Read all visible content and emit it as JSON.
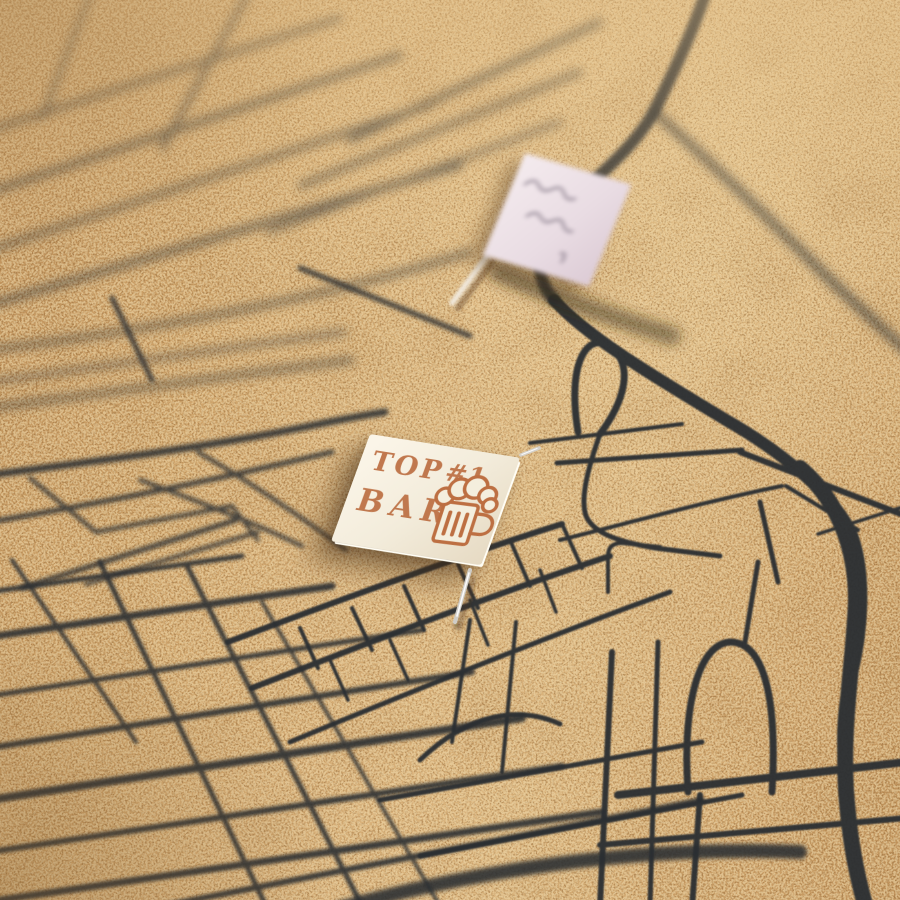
{
  "scene": {
    "type": "photograph",
    "subject": "Close-up of a cork pinboard printed with a dark city street map, marked with two pinned paper flags",
    "cork_color": "#cda269",
    "map_line_color": "#2b2e32"
  },
  "bar_flag": {
    "word_top": "TOP",
    "word_rank": "#1",
    "word_bar": "BAR",
    "icon": "beer-mug-icon",
    "text_color": "#bd6f42",
    "face_color": "#f4eedf"
  },
  "note_flag": {
    "face_color": "#ebdfe6",
    "writing_color": "#8a7e8c",
    "text_legible": false
  },
  "pins": {
    "metal_color": "#d0cdc7",
    "stick_color": "#f1e9dd"
  }
}
